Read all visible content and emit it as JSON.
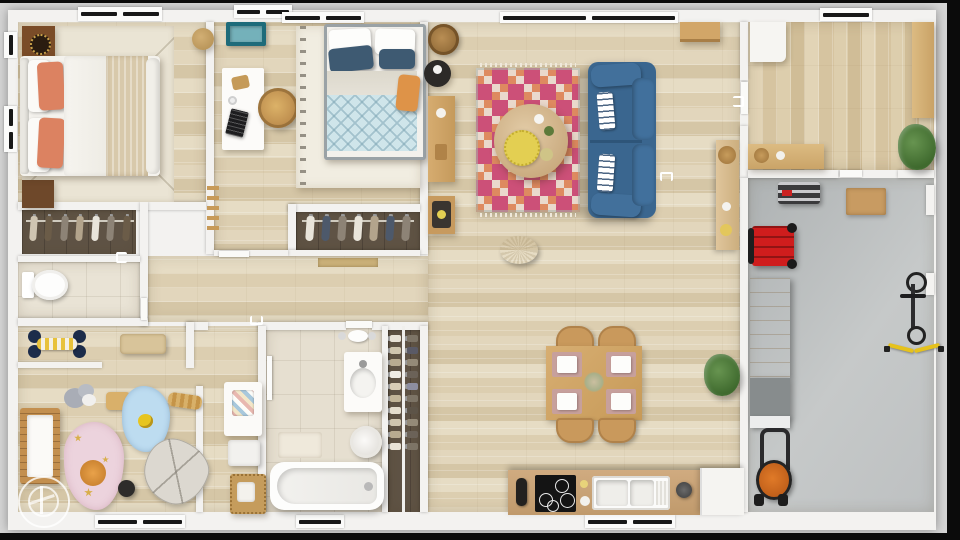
{
  "scene": {
    "type": "floor-plan-3d-top-view",
    "description": "Top-down 3D render of a single-storey house with attached garage",
    "rooms": [
      {
        "id": "master-bedroom",
        "furniture": [
          "double-bed",
          "coral-pillows",
          "knit-throw",
          "headboard",
          "nightstand",
          "speaker-cabinet",
          "area-rug",
          "pouf"
        ]
      },
      {
        "id": "master-closet",
        "furniture": [
          "clothes-rail-7-hangers"
        ]
      },
      {
        "id": "wc",
        "furniture": [
          "toilet"
        ]
      },
      {
        "id": "nursery",
        "furniture": [
          "crib",
          "pink-cloud-rug",
          "blue-cloud-rug",
          "elephant-playmat",
          "plush-elephant",
          "toy-roller",
          "wooden-bench",
          "toy-xylophone",
          "toy-figures",
          "black-pouf",
          "changing-table",
          "laundry-hamper",
          "wicker-basket"
        ]
      },
      {
        "id": "bathroom",
        "furniture": [
          "bathtub",
          "vanity-sink",
          "round-hamper",
          "bath-mat",
          "wall-faucet"
        ]
      },
      {
        "id": "wardrobe",
        "furniture": [
          "clothes-column-left",
          "clothes-column-right"
        ]
      },
      {
        "id": "bedroom-2",
        "furniture": [
          "double-bed-blue-quilt",
          "navy-pillows",
          "orange-pillow",
          "white-desk",
          "laptop",
          "rattan-stool",
          "teal-tray",
          "white-shag-rug",
          "blanket-ladder"
        ]
      },
      {
        "id": "closet-2",
        "furniture": [
          "clothes-rail-7-hangers",
          "door-mat"
        ]
      },
      {
        "id": "living-room",
        "furniture": [
          "blue-sofa",
          "striped-pillows",
          "geometric-diamond-rug",
          "round-coffee-table",
          "gold-fringed-tray",
          "knit-pouf",
          "wood-sideboard",
          "bench-with-tray",
          "woven-basket",
          "black-side-table",
          "wall-console",
          "top-bench"
        ]
      },
      {
        "id": "dining-area",
        "furniture": [
          "square-dining-table",
          "four-wood-chairs",
          "four-place-settings",
          "flower-centerpiece",
          "potted-plant"
        ]
      },
      {
        "id": "kitchen",
        "furniture": [
          "tan-counter",
          "induction-cooktop",
          "double-sink",
          "faucet",
          "white-cabinet"
        ]
      },
      {
        "id": "entry",
        "furniture": [
          "white-shoe-cabinet",
          "wood-sideboard",
          "wood-counter",
          "potted-plant"
        ]
      },
      {
        "id": "garage",
        "furniture": [
          "workbench",
          "red-tool-cart",
          "step-stool",
          "cork-mat",
          "storage-cabinet",
          "wall-shelf",
          "lawn-mower",
          "bicycle",
          "yellow-resistance-straps"
        ]
      }
    ],
    "windows": {
      "top": 5,
      "bottom": 3,
      "left": 2
    },
    "watermark": "double-circle-emblem"
  },
  "palette": {
    "bg": "#d6d6d6",
    "wall": "#f3f2f0",
    "rug-pink": "#cc5078",
    "rug-orange": "#de8a60",
    "sofa-blue": "#3a668f",
    "sofa-blue-dark": "#2e5579",
    "coral": "#dc8261",
    "knit-throw": "#d6c6a8",
    "navy-pillow": "#3e5a72",
    "quilt-blue": "#cfe5ea",
    "orange-pillow": "#de9348",
    "teal": "#1e6b7a",
    "teal-light": "#74b1ba",
    "crib-wood": "#c38f4f",
    "pink-rug": "#ecd3dd",
    "blue-rug": "#bddcf0",
    "red-cart": "#cf1d1d",
    "mower-orange": "#d2691e",
    "counter-tan": "#c9a479",
    "table-wood": "#d2a96b",
    "gold": "#e3cf52",
    "dark-wood": "#7a4c28"
  }
}
